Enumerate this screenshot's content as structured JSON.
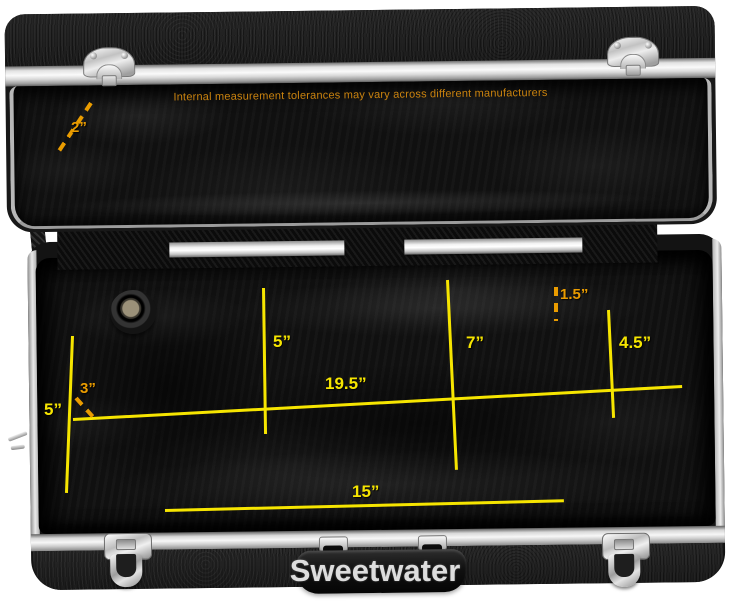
{
  "window": {
    "width": 750,
    "height": 602,
    "background": "#ffffff"
  },
  "photo": {
    "subject": "molded hard instrument case shown open with plush interior",
    "watermark": "Sweetwater",
    "disclaimer": "Internal measurement tolerances may vary across different manufacturers"
  },
  "colors": {
    "solid_line": "#f6e500",
    "dashed_line": "#ea9c00",
    "disclaimer_text": "#c9820e",
    "watermark_text": "#e4e4e4",
    "case_black": "#1c1c1c",
    "plush_black": "#101010",
    "aluminum_trim": "#d9d9d9"
  },
  "measurements": {
    "lid_depth": {
      "label": "2”",
      "style": "dashed"
    },
    "bell_height": {
      "label": "5”",
      "style": "solid"
    },
    "bell_inset": {
      "label": "3”",
      "style": "dashed"
    },
    "neck_width": {
      "label": "5”",
      "style": "solid"
    },
    "overall_length": {
      "label": "19.5”",
      "style": "solid"
    },
    "body_width": {
      "label": "7”",
      "style": "solid"
    },
    "bow_width": {
      "label": "4.5”",
      "style": "solid"
    },
    "accessory_depth": {
      "label": "1.5”",
      "style": "dashed"
    },
    "lower_length": {
      "label": "15”",
      "style": "solid"
    }
  }
}
